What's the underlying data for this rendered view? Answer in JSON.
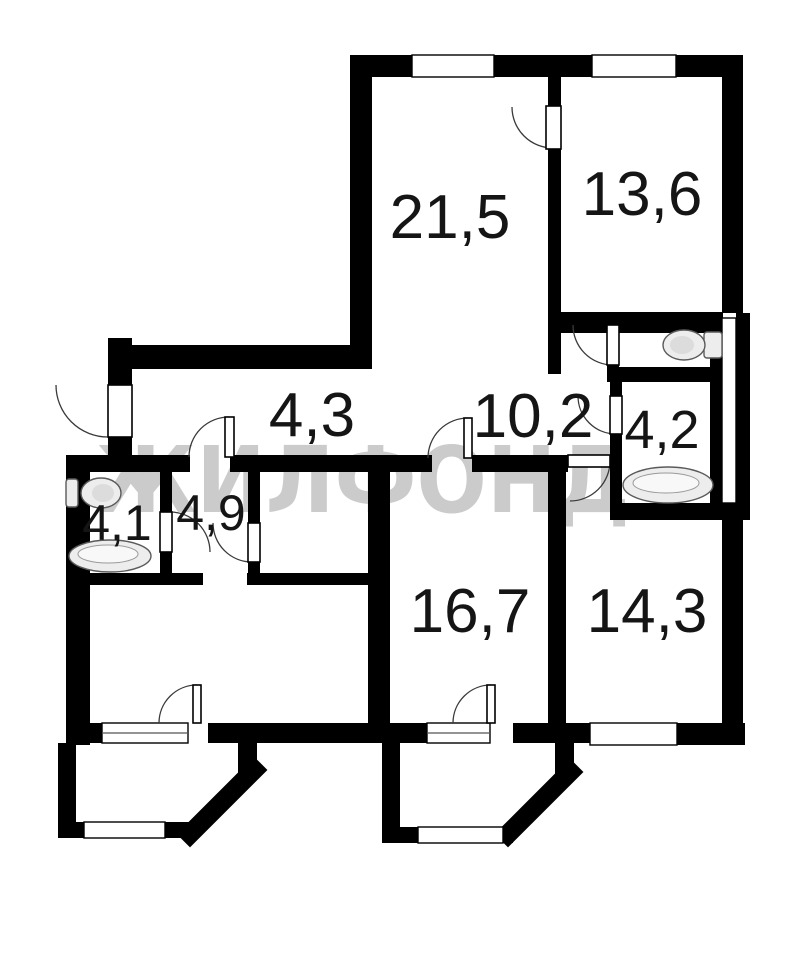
{
  "document": {
    "type": "apartment-floor-plan",
    "background": "#ffffff"
  },
  "watermark": {
    "text": "ЖИЛФОНД",
    "color": "#c3c3c3"
  },
  "colors": {
    "wall": "#000000",
    "label": "#151515",
    "fixture_stroke": "#5a5a5a"
  },
  "rooms": [
    {
      "name": "living-room",
      "area": "21,5"
    },
    {
      "name": "room-top-right",
      "area": "13,6"
    },
    {
      "name": "corridor",
      "area": "4,3"
    },
    {
      "name": "hallway",
      "area": "10,2"
    },
    {
      "name": "bathroom-right",
      "area": "4,2"
    },
    {
      "name": "bathroom-left",
      "area": "4,1"
    },
    {
      "name": "inner-hall",
      "area": "4,9"
    },
    {
      "name": "room-bottom-middle",
      "area": "16,7"
    },
    {
      "name": "room-bottom-right",
      "area": "14,3"
    }
  ],
  "fixtures": [
    "toilet-in-wc",
    "toilet-in-left-bathroom",
    "bathtub-in-left-bathroom",
    "bathtub-in-right-bathroom"
  ],
  "features": [
    "two-balconies-with-chamfered-corners",
    "entrance-door-left",
    "vent-shaft-right"
  ]
}
